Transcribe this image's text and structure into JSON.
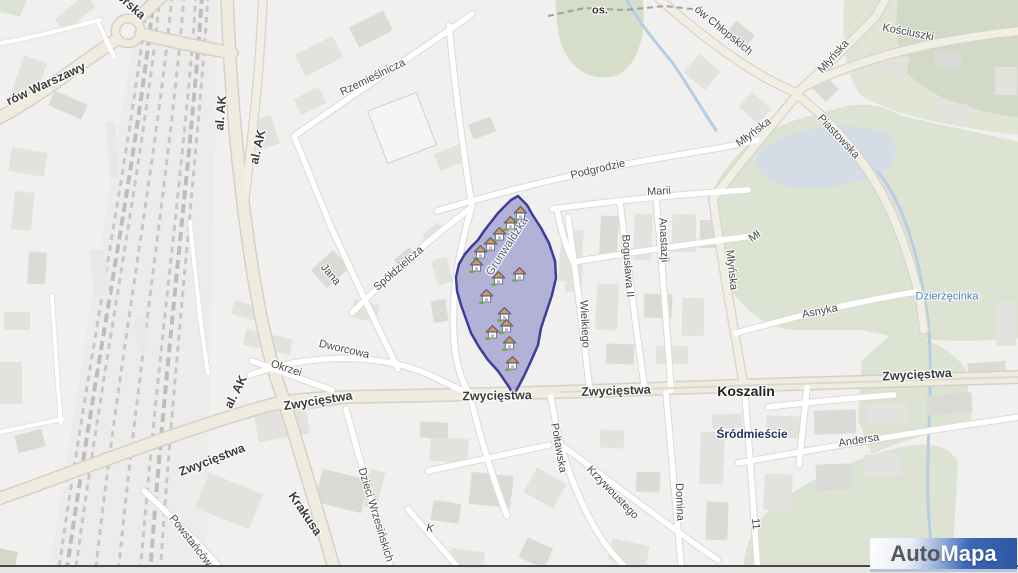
{
  "brand": {
    "part1": "Auto",
    "part2": "Mapa"
  },
  "map": {
    "city": "Koszalin",
    "district": "Śródmieście",
    "locality": "os.",
    "river": "Dzierżęcinka",
    "selected_zone_street": "Grunwaldzka",
    "colors": {
      "zone_fill": "#8b89c6",
      "zone_border": "#3d3e9b",
      "major_road": "#efecdf",
      "street": "#ffffff",
      "park": "#dde3d2",
      "water": "#bdd1e4",
      "railway": "#c7c7c7",
      "building": "#e3e2df",
      "logo_blue": "#3a66b5"
    },
    "labels": [
      {
        "t": "orska",
        "x": 131,
        "y": 6,
        "r": 42,
        "c": "major"
      },
      {
        "t": "rów Warszawy",
        "x": 46,
        "y": 84,
        "r": -25,
        "c": "major"
      },
      {
        "t": "al. AK",
        "x": 221,
        "y": 113,
        "r": -85,
        "c": "major"
      },
      {
        "t": "al. AK",
        "x": 258,
        "y": 147,
        "r": -77,
        "c": "major"
      },
      {
        "t": "al. AK",
        "x": 236,
        "y": 392,
        "r": -63,
        "c": "major"
      },
      {
        "t": "Zwycięstwa",
        "x": 212,
        "y": 460,
        "r": -21,
        "c": "major"
      },
      {
        "t": "Zwycięstwa",
        "x": 318,
        "y": 401,
        "r": -9,
        "c": "major"
      },
      {
        "t": "Zwycięstwa",
        "x": 497,
        "y": 396,
        "r": -1,
        "c": "major"
      },
      {
        "t": "Zwycięstwa",
        "x": 616,
        "y": 391,
        "r": -2,
        "c": "major"
      },
      {
        "t": "Zwycięstwa",
        "x": 917,
        "y": 375,
        "r": -3,
        "c": "major"
      },
      {
        "t": "Krakusa",
        "x": 305,
        "y": 514,
        "r": 56,
        "c": "major"
      },
      {
        "t": "Rzemieślnicza",
        "x": 373,
        "y": 78,
        "r": -26,
        "c": "street"
      },
      {
        "t": "Spółdzielcza",
        "x": 399,
        "y": 269,
        "r": -41,
        "c": "street"
      },
      {
        "t": "Jana",
        "x": 330,
        "y": 275,
        "r": 50,
        "c": "street"
      },
      {
        "t": "Dworcowa",
        "x": 344,
        "y": 350,
        "r": 13,
        "c": "street"
      },
      {
        "t": "Okrzei",
        "x": 286,
        "y": 369,
        "r": 18,
        "c": "street"
      },
      {
        "t": "Podgrodzie",
        "x": 598,
        "y": 170,
        "r": -13,
        "c": "street"
      },
      {
        "t": "Marii",
        "x": 659,
        "y": 192,
        "r": -3,
        "c": "street"
      },
      {
        "t": "Anastazji",
        "x": 663,
        "y": 240,
        "r": 87,
        "c": "street"
      },
      {
        "t": "Bogusława II",
        "x": 627,
        "y": 266,
        "r": 86,
        "c": "street"
      },
      {
        "t": "Wielkiego",
        "x": 584,
        "y": 324,
        "r": 87,
        "c": "street"
      },
      {
        "t": "Młyńska",
        "x": 754,
        "y": 133,
        "r": -37,
        "c": "street"
      },
      {
        "t": "Młyńska",
        "x": 834,
        "y": 57,
        "r": -48,
        "c": "street"
      },
      {
        "t": "Młyńska",
        "x": 731,
        "y": 270,
        "r": 84,
        "c": "street"
      },
      {
        "t": "Mł",
        "x": 755,
        "y": 237,
        "r": -33,
        "c": "street"
      },
      {
        "t": "ów Chłopskich",
        "x": 723,
        "y": 31,
        "r": 39,
        "c": "street"
      },
      {
        "t": "Kościuszki",
        "x": 908,
        "y": 33,
        "r": 11,
        "c": "street"
      },
      {
        "t": "Piastowska",
        "x": 838,
        "y": 137,
        "r": 47,
        "c": "street"
      },
      {
        "t": "Asnyka",
        "x": 820,
        "y": 312,
        "r": -11,
        "c": "street"
      },
      {
        "t": "Andersa",
        "x": 859,
        "y": 441,
        "r": -9,
        "c": "street"
      },
      {
        "t": "Połtawska",
        "x": 558,
        "y": 448,
        "r": 80,
        "c": "street"
      },
      {
        "t": "Krzywoustego",
        "x": 612,
        "y": 493,
        "r": 46,
        "c": "street"
      },
      {
        "t": "Domina",
        "x": 679,
        "y": 502,
        "r": 88,
        "c": "street"
      },
      {
        "t": "11",
        "x": 755,
        "y": 524,
        "r": 85,
        "c": "street"
      },
      {
        "t": "Dzieci Wrzesińskich",
        "x": 375,
        "y": 515,
        "r": 73,
        "c": "street"
      },
      {
        "t": "Powstańców",
        "x": 190,
        "y": 541,
        "r": 52,
        "c": "street"
      },
      {
        "t": "K",
        "x": 430,
        "y": 529,
        "r": 15,
        "c": "street"
      },
      {
        "t": "Koszalin",
        "x": 746,
        "y": 391,
        "r": 0,
        "c": "city"
      },
      {
        "t": "Śródmieście",
        "x": 752,
        "y": 434,
        "r": 0,
        "c": "district"
      },
      {
        "t": "os.",
        "x": 600,
        "y": 11,
        "r": 0,
        "c": "locality"
      },
      {
        "t": "Dzierżęcinka",
        "x": 947,
        "y": 297,
        "r": 0,
        "c": "river"
      },
      {
        "t": "Grunwaldzka",
        "x": 508,
        "y": 247,
        "r": -57,
        "c": "zone"
      }
    ],
    "houses": [
      [
        520,
        214
      ],
      [
        510,
        224
      ],
      [
        499,
        235
      ],
      [
        490,
        245
      ],
      [
        480,
        253
      ],
      [
        476,
        266
      ],
      [
        519,
        275
      ],
      [
        498,
        279
      ],
      [
        486,
        297
      ],
      [
        504,
        315
      ],
      [
        506,
        327
      ],
      [
        492,
        333
      ],
      [
        509,
        344
      ],
      [
        512,
        364
      ]
    ]
  }
}
